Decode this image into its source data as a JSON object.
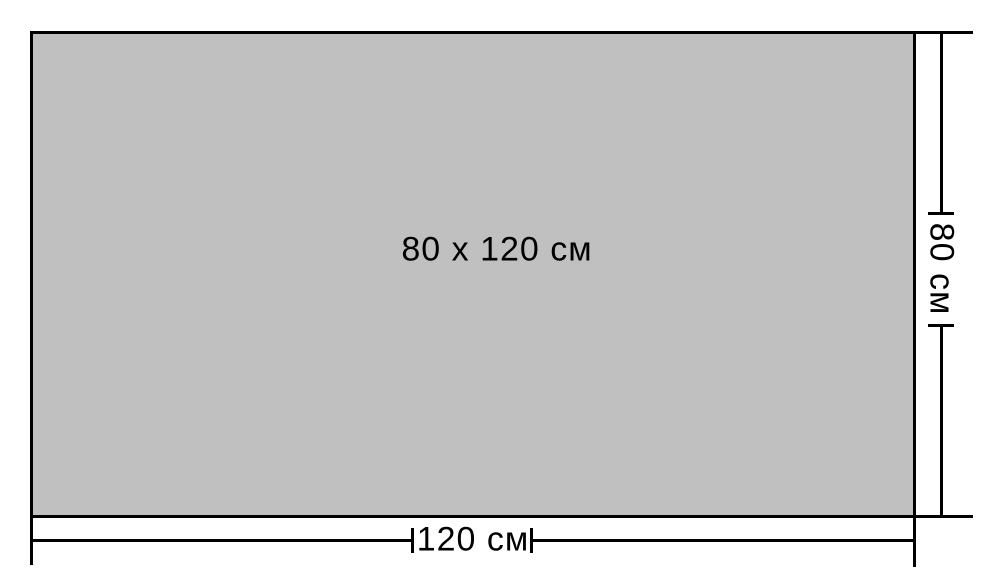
{
  "diagram": {
    "type": "dimensioned-rectangle",
    "center_label": "80 x 120 см",
    "width_dimension": {
      "label": "120 см",
      "value_cm": 120
    },
    "height_dimension": {
      "label": "80 см",
      "value_cm": 80
    }
  },
  "colors": {
    "background": "#ffffff",
    "rectangle_fill": "#c0c0c0",
    "line": "#000000",
    "text": "#000000"
  }
}
